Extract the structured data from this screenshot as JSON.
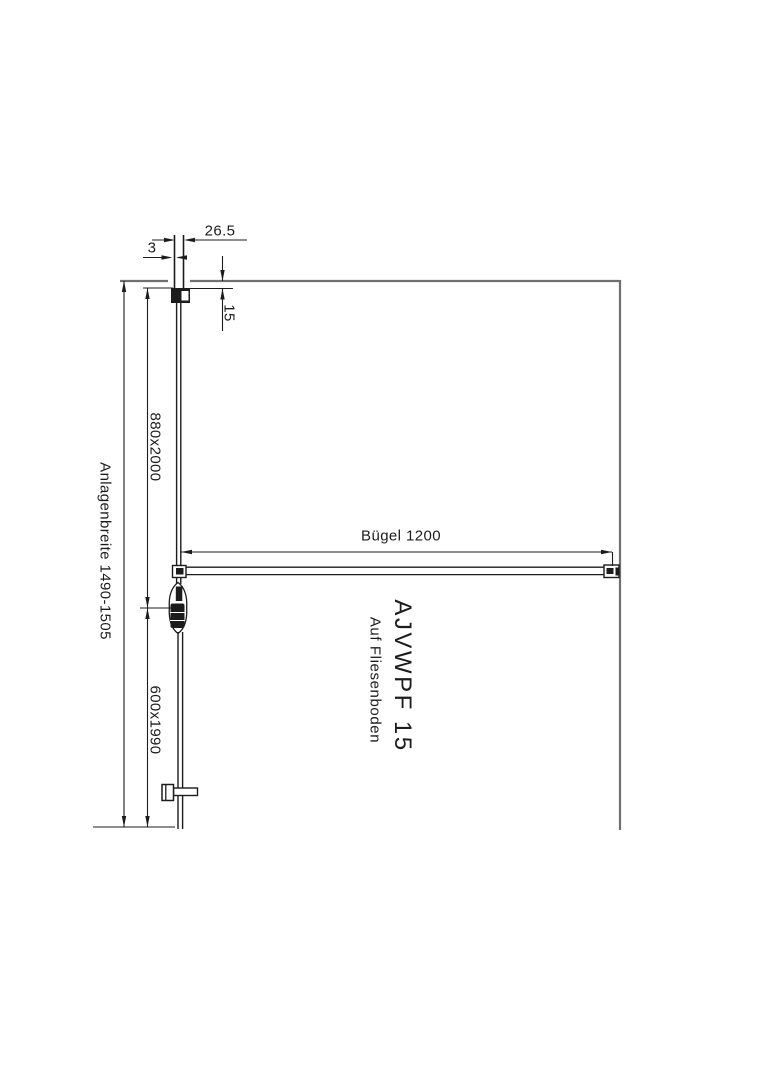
{
  "drawing": {
    "type": "technical-plan-view",
    "colors": {
      "line": "#1c1c1c",
      "wall": "#707070",
      "background": "#ffffff"
    },
    "dimensions": {
      "profile_width": "26.5",
      "gap": "3",
      "wall_offset": "15",
      "fixed_panel": "880x2000",
      "total_width": "Anlagenbreite 1490-1505",
      "door_panel": "600x1990",
      "support_bar": "Bügel 1200"
    },
    "labels": {
      "model": "AJVWPF 15",
      "floor_note": "Auf Fliesenboden"
    }
  }
}
